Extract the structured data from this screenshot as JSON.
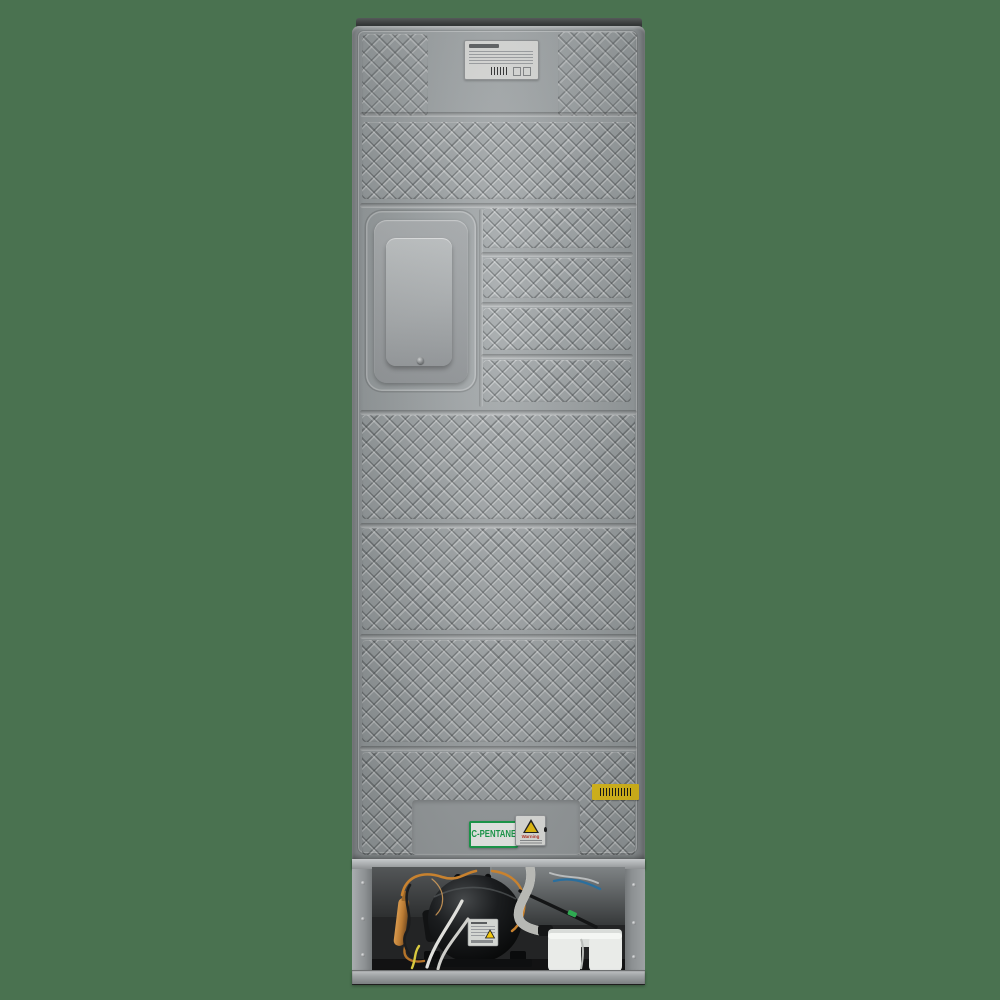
{
  "photo": {
    "subject": "refrigerator-back-panel-rear-view"
  },
  "stickers": {
    "c_pentane": {
      "label": "C-PENTANE",
      "text_color": "#18a14b",
      "background": "#f6f8f5",
      "border_color": "#18a14b"
    },
    "fire_warning": {
      "label": "Warning",
      "label_color": "#c03325",
      "triangle_color": "#f2c70e",
      "background": "#e8e9e6",
      "symbol": "flame-warning-triangle-icon"
    },
    "barcode": {
      "background": "#e7c51d",
      "content": "black-barcode-lines"
    },
    "rating_plate": {
      "background": "#d9dad8",
      "content": "manufacturer-logo-and-fine-print-specifications-with-barcode"
    },
    "compressor_label": {
      "background": "#d3d6d2",
      "content": "compressor-specifications",
      "symbol": "yellow-warning-triangle-icon"
    }
  },
  "colors": {
    "backdrop_green": "#4a7250",
    "panel_gray": "#9aa0a2",
    "panel_highlight": "#c6cacb",
    "panel_shadow": "#6f7375",
    "top_cap": "#343737",
    "compartment_interior": "#232425",
    "metal_rail": "#b2b5b7",
    "copper_tube": "#c8822f",
    "filter_drier": "#b97a33",
    "compressor_black": "#17181a",
    "drain_hose_white": "#dadbd7",
    "drain_tray_white": "#e9ebe8",
    "wire_yellow": "#d8c93f",
    "wire_blue": "#2a6f9e",
    "wire_white": "#e0e0dc",
    "connector_green": "#2faa52"
  },
  "parts": [
    "top-cap",
    "back-panel",
    "diamond-texture-band",
    "embossed-access-cover",
    "cover-screw",
    "rating-plate",
    "c-pentane-sticker",
    "fire-warning-sticker",
    "barcode-sticker",
    "machine-compartment",
    "compressor",
    "compressor-label",
    "filter-drier",
    "copper-tubing",
    "drain-hose",
    "drain-tray",
    "wiring-harness",
    "side-wall",
    "top-rail",
    "bottom-rail"
  ]
}
